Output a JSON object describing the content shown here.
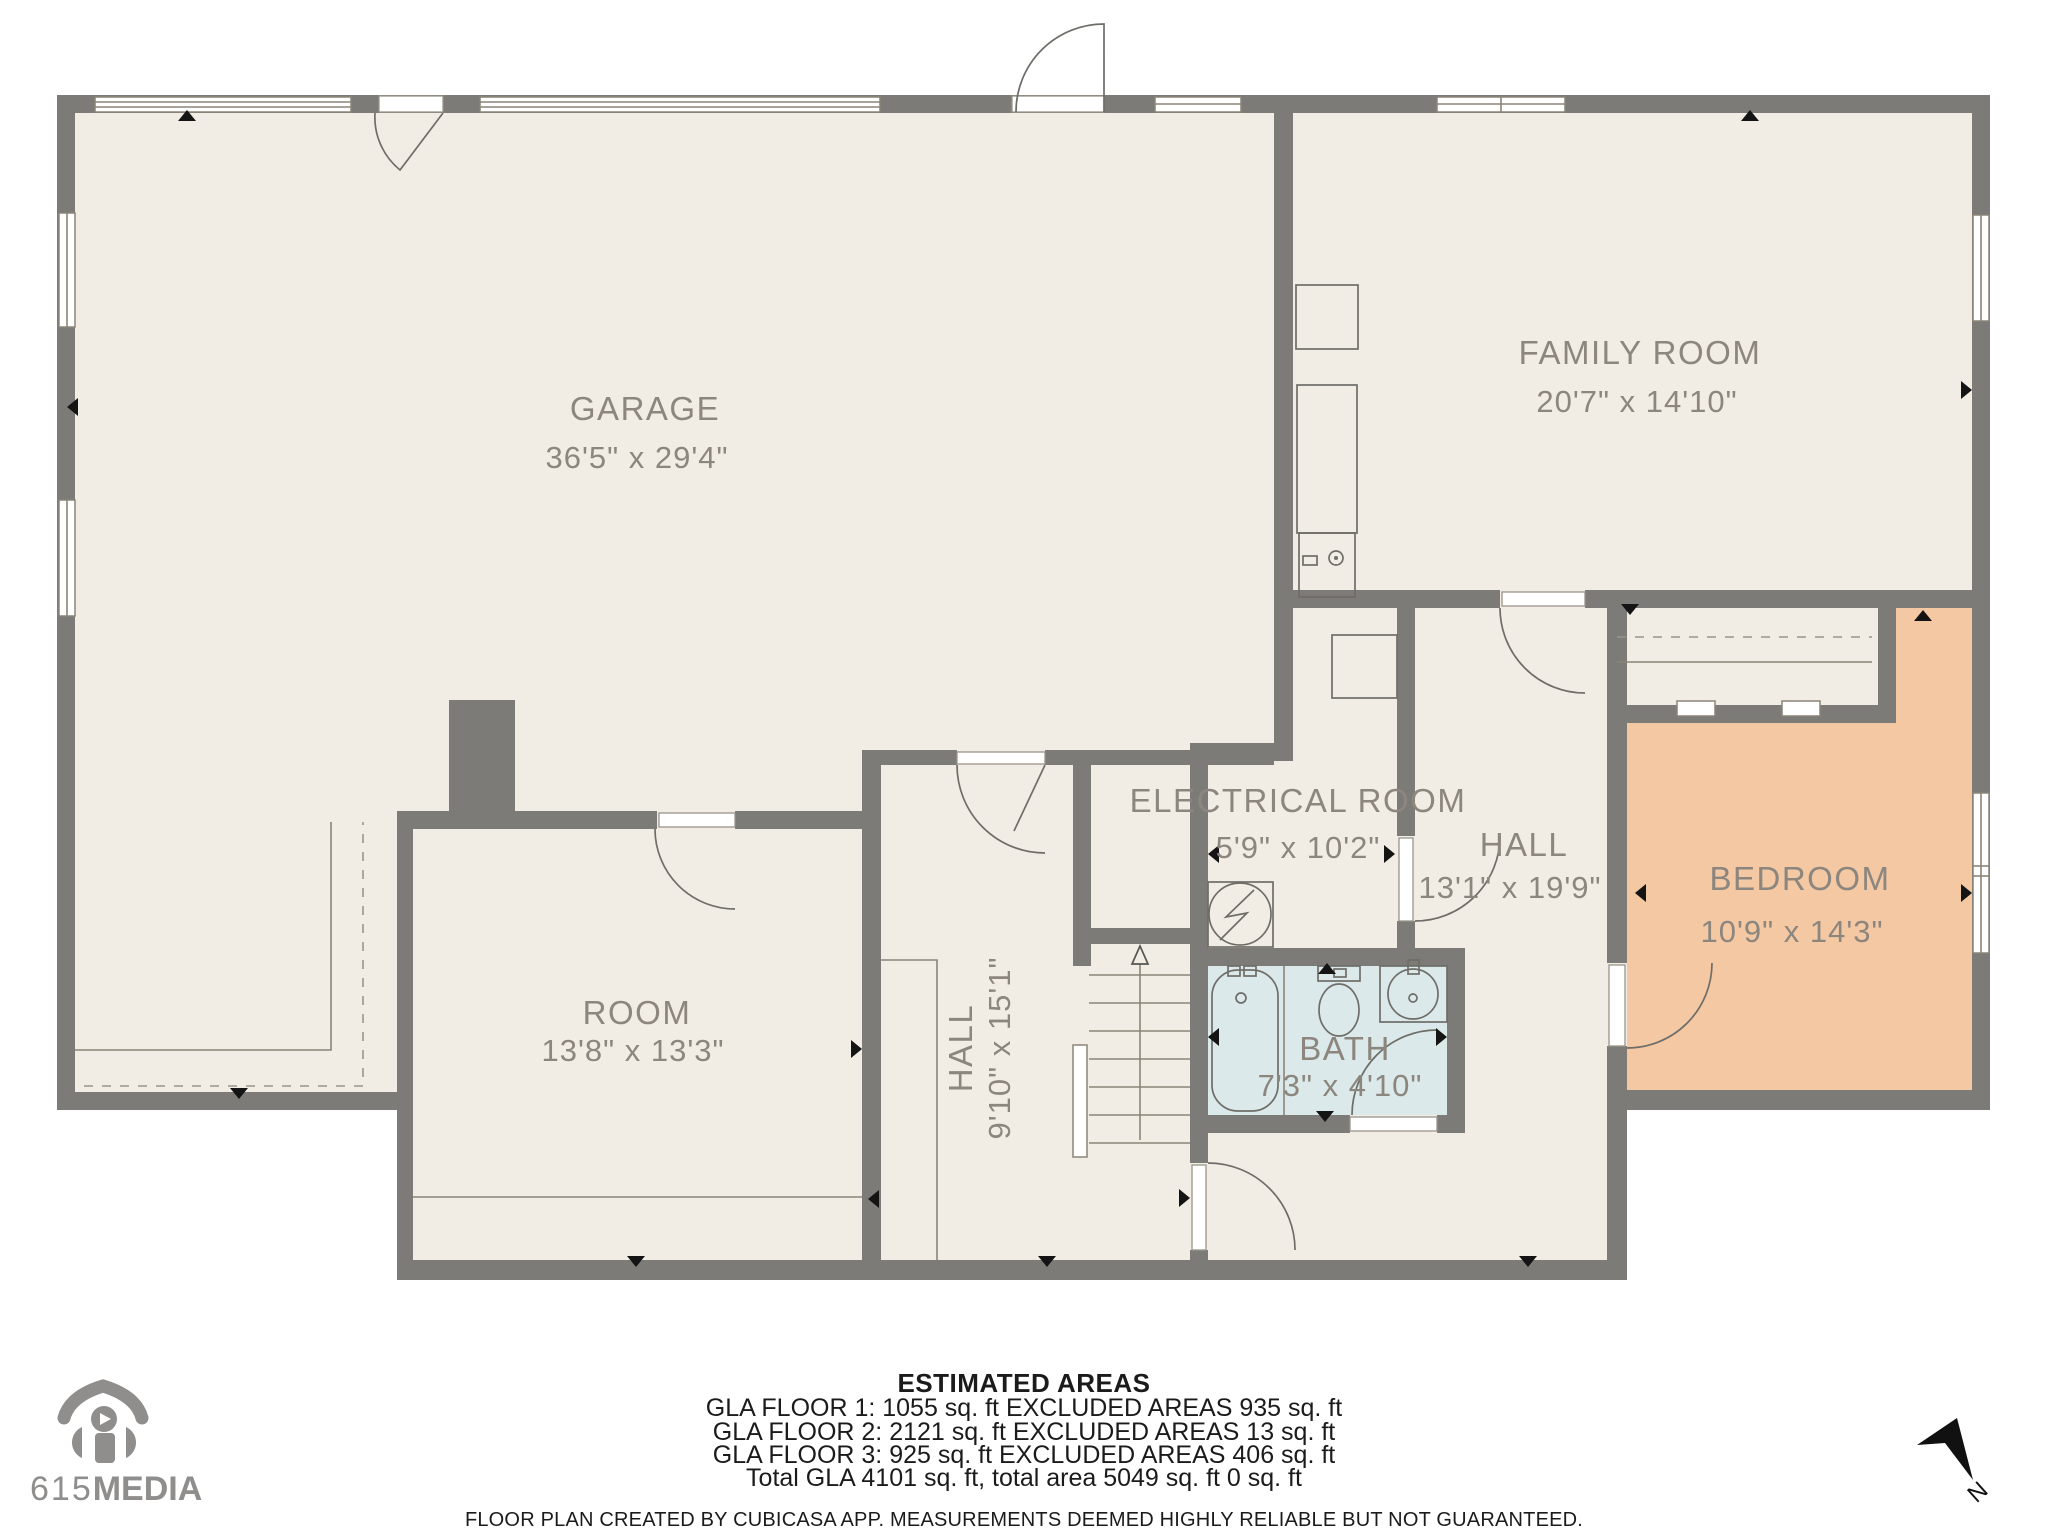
{
  "palette": {
    "background": "#ffffff",
    "floor": "#f2ede4",
    "wall": "#7d7b77",
    "label": "#8c867e",
    "bedroom_fill": "#f3c8a3",
    "bath_fill": "#dbe9ea",
    "marker": "#141414",
    "logo_gray": "#8f8e8c",
    "text_black": "#1b1b1b"
  },
  "rooms": [
    {
      "name": "GARAGE",
      "dims": "36'5\" x 29'4\""
    },
    {
      "name": "FAMILY ROOM",
      "dims": "20'7\" x 14'10\""
    },
    {
      "name": "ELECTRICAL ROOM",
      "dims": "5'9\" x 10'2\""
    },
    {
      "name": "HALL",
      "dims": "13'1\" x 19'9\""
    },
    {
      "name": "BEDROOM",
      "dims": "10'9\" x 14'3\""
    },
    {
      "name": "ROOM",
      "dims": "13'8\" x 13'3\""
    },
    {
      "name": "HALL",
      "dims": "9'10\" x 15'1\""
    },
    {
      "name": "BATH",
      "dims": "7'3\" x 4'10\""
    }
  ],
  "estimated_areas": {
    "title": "ESTIMATED AREAS",
    "lines": [
      "GLA FLOOR 1: 1055 sq. ft EXCLUDED AREAS 935 sq. ft",
      "GLA FLOOR 2: 2121 sq. ft EXCLUDED AREAS 13 sq. ft",
      "GLA FLOOR 3: 925 sq. ft EXCLUDED AREAS 406 sq. ft",
      "Total GLA 4101 sq. ft, total area 5049 sq. ft 0 sq. ft"
    ],
    "disclaimer": "FLOOR PLAN CREATED BY CUBICASA APP. MEASUREMENTS DEEMED HIGHLY RELIABLE BUT NOT GUARANTEED."
  },
  "branding": {
    "logo_light": "615",
    "logo_bold": "MEDIA"
  },
  "compass": {
    "north_label": "N"
  }
}
